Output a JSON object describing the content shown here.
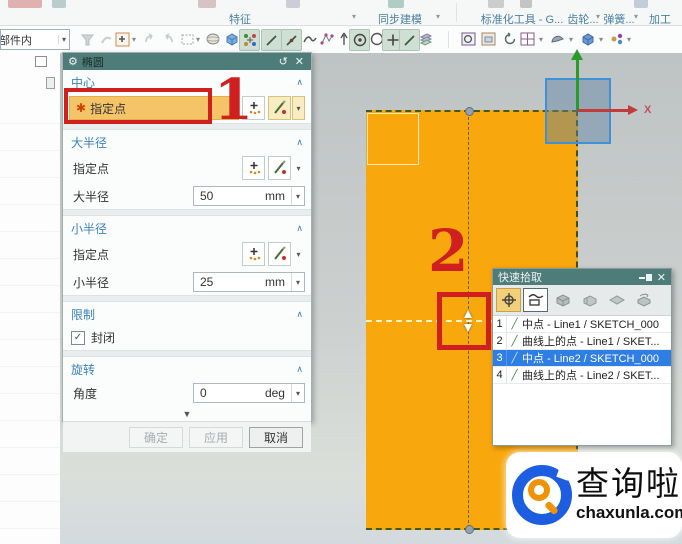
{
  "ribbon": {
    "groups": [
      {
        "label": "特征"
      },
      {
        "label": "同步建模"
      },
      {
        "label": "标准化工具 - G..."
      },
      {
        "label": "齿轮..."
      },
      {
        "label": "弹簧..."
      },
      {
        "label": "加工"
      }
    ],
    "caret": "▾"
  },
  "toolbar": {
    "scope_combo_value": "部件内",
    "caret": "▾"
  },
  "dialog": {
    "title": "椭圆",
    "gear_icon": "⚙",
    "reset_icon": "↺",
    "close_icon": "✕",
    "section_caret": "∧",
    "dropdown_caret": "▾",
    "collapse_caret": "▼",
    "center": {
      "header": "中心",
      "asterisk": "✱",
      "specify_point": "指定点"
    },
    "major": {
      "header": "大半径",
      "specify_point": "指定点",
      "radius_label": "大半径",
      "value": "50",
      "unit": "mm"
    },
    "minor": {
      "header": "小半径",
      "specify_point": "指定点",
      "radius_label": "小半径",
      "value": "25",
      "unit": "mm"
    },
    "limits": {
      "header": "限制",
      "closed_label": "封闭",
      "checkmark": "✓"
    },
    "rotation": {
      "header": "旋转",
      "angle_label": "角度",
      "value": "0",
      "unit": "deg"
    },
    "buttons": {
      "ok": "确定",
      "apply": "应用",
      "cancel": "取消"
    }
  },
  "quick_pick": {
    "title": "快速拾取",
    "close_icon": "✕",
    "items": [
      {
        "num": "1",
        "icon": "╱",
        "label": "中点 - Line1 / SKETCH_000"
      },
      {
        "num": "2",
        "icon": "╱",
        "label": "曲线上的点 - Line1 / SKET..."
      },
      {
        "num": "3",
        "icon": "╱",
        "label": "中点 - Line2 / SKETCH_000"
      },
      {
        "num": "4",
        "icon": "╱",
        "label": "曲线上的点 - Line2 / SKET..."
      }
    ]
  },
  "annotations": {
    "step1": "1",
    "step2": "2"
  },
  "canvas": {
    "x_axis_label": "X"
  },
  "watermark": {
    "brand": "查询啦",
    "domain": "chaxunla.com"
  },
  "colors": {
    "titlebar_teal": "#4e7d79",
    "sketch_orange": "#f8a70c",
    "required_field_amber": "#f6c468",
    "selection_blue": "#2f7ee3",
    "annotation_red": "#cf1f1f",
    "section_header_blue": "#3b82bd",
    "axis_x_red": "#c23a3a",
    "axis_y_green": "#2a9a2a",
    "brand_blue": "#1d5de0",
    "brand_orange": "#f09205"
  }
}
